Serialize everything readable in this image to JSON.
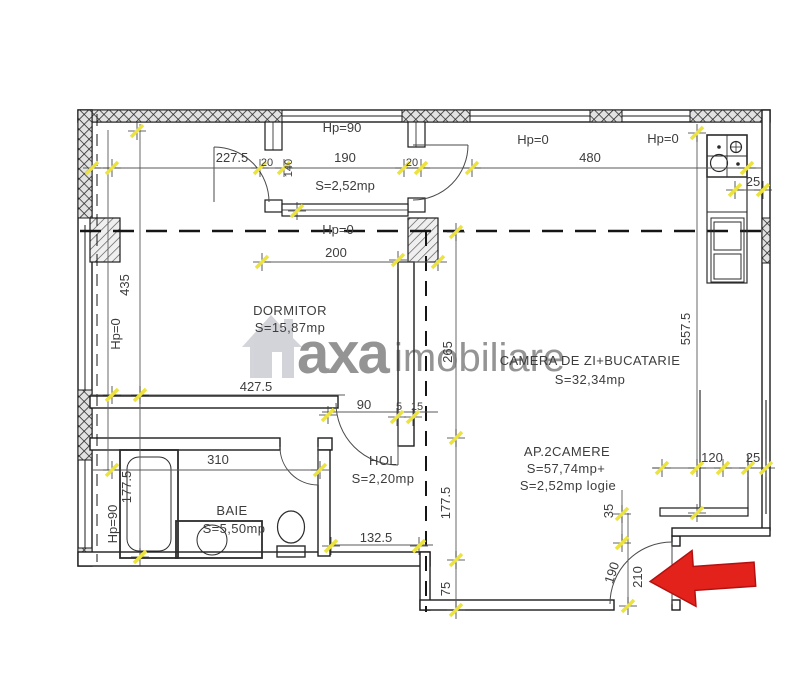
{
  "watermark": {
    "brand_gray": "axa",
    "brand_pink": "imobiliare"
  },
  "rooms": {
    "dormitor": {
      "name": "DORMITOR",
      "area": "S=15,87mp"
    },
    "camera_zi": {
      "name": "CAMERA DE ZI+BUCATARIE",
      "area": "S=32,34mp"
    },
    "hol": {
      "name": "HOL",
      "area": "S=2,20mp"
    },
    "baie": {
      "name": "BAIE",
      "area": "S=5,50mp"
    },
    "logie": {
      "area": "S=2,52mp"
    }
  },
  "summary": {
    "line1": "AP.2CAMERE",
    "line2": "S=57,74mp+",
    "line3": "S=2,52mp  logie"
  },
  "entrance_label": "AP",
  "parapet_labels": {
    "loggia_top": "Hp=90",
    "top_a": "Hp=0",
    "top_b": "Hp=0",
    "loggia_bottom": "Hp=0",
    "left_upper": "Hp=0",
    "left_lower": "Hp=90"
  },
  "dimensions": {
    "d227_5": "227.5",
    "d20a": "20",
    "d140": "140",
    "d190": "190",
    "d20b": "20",
    "d480": "480",
    "d25_counter": "25",
    "d200": "200",
    "d435": "435",
    "d427_5": "427.5",
    "d90": "90",
    "d5": "5",
    "d15": "15",
    "d265": "265",
    "d557_5": "557.5",
    "d310": "310",
    "d177_5_baie": "177.5",
    "d132_5": "132.5",
    "d177_5_hol": "177.5",
    "d75": "75",
    "d120": "120",
    "d25_entry": "25",
    "d35": "35",
    "d190_door": "190",
    "d210": "210"
  },
  "colors": {
    "tick": "#ece33e",
    "arrow": "#e3231b",
    "watermark_gray": "#aeb2bd",
    "watermark_pink": "#f2a9b4",
    "line": "#1c1c1c",
    "dim": "#5a5a5a"
  }
}
